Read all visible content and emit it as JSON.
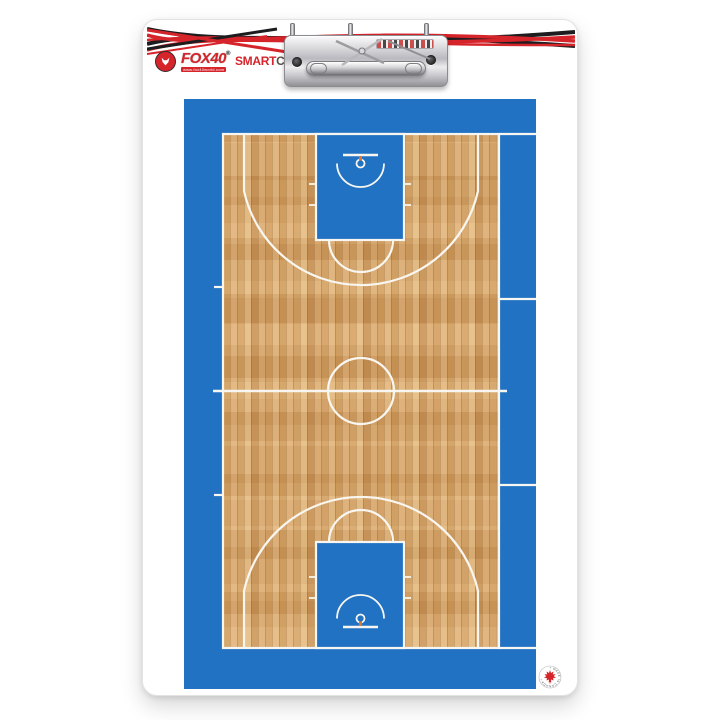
{
  "branding": {
    "fox40_wordmark": "FOX40",
    "registered_mark": "®",
    "website": "www.fox40world.com",
    "smart": "SMART",
    "coach": "COACH",
    "trademark_mark": "™"
  },
  "made_in_canada_badge": {
    "label": "• MADE IN CANADA •"
  },
  "icons": {
    "fox_head": "fox-head-icon",
    "maple_leaf": "maple-leaf-icon"
  },
  "colors": {
    "court_blue": "#2272c3",
    "line_white": "#f8f6f0",
    "wood_base": "#d8a668",
    "brand_red": "#d6242b",
    "stripe_black": "#1d1d1f",
    "rim_orange": "#e0772e",
    "coach_gray": "#5b5047",
    "board_white": "#ffffff"
  }
}
